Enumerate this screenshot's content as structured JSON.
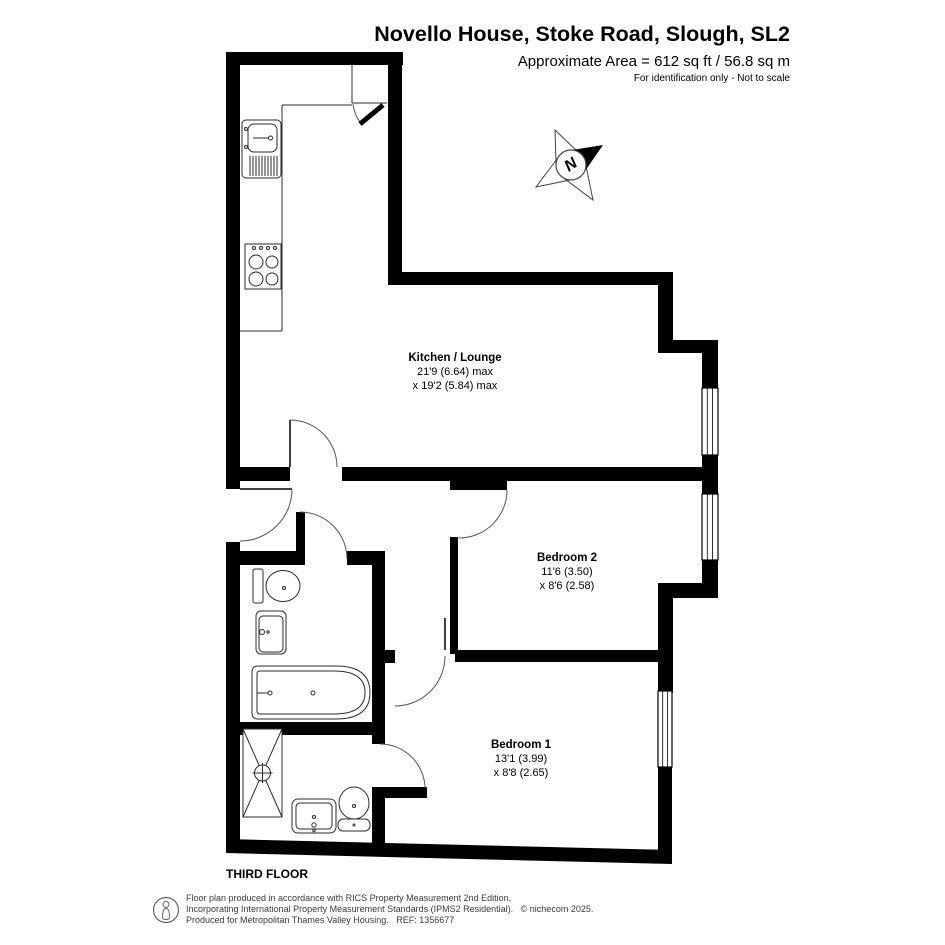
{
  "header": {
    "title": "Novello House, Stoke Road, Slough, SL2",
    "area": "Approximate Area = 612 sq ft / 56.8 sq m",
    "note": "For identification only - Not to scale"
  },
  "rooms": [
    {
      "name": "Kitchen / Lounge",
      "dim1": "21'9 (6.64) max",
      "dim2": "x 19'2 (5.84) max"
    },
    {
      "name": "Bedroom 2",
      "dim1": "11'6 (3.50)",
      "dim2": "x 8'6 (2.58)"
    },
    {
      "name": "Bedroom 1",
      "dim1": "13'1 (3.99)",
      "dim2": "x 8'8 (2.65)"
    }
  ],
  "floor": {
    "label": "THIRD FLOOR"
  },
  "compass": {
    "north_label": "N"
  },
  "footer": {
    "line1": "Floor plan produced in accordance with RICS Property Measurement 2nd Edition,",
    "line2": "Incorporating International Property Measurement Standards (IPMS2 Residential).   © nichecom 2025.",
    "line3": "Produced for Metropolitan Thames Valley Housing.   REF: 1356677"
  },
  "colors": {
    "walls": "#000000",
    "background": "#ffffff",
    "text": "#000000",
    "footer_text": "#3a3a3a"
  }
}
